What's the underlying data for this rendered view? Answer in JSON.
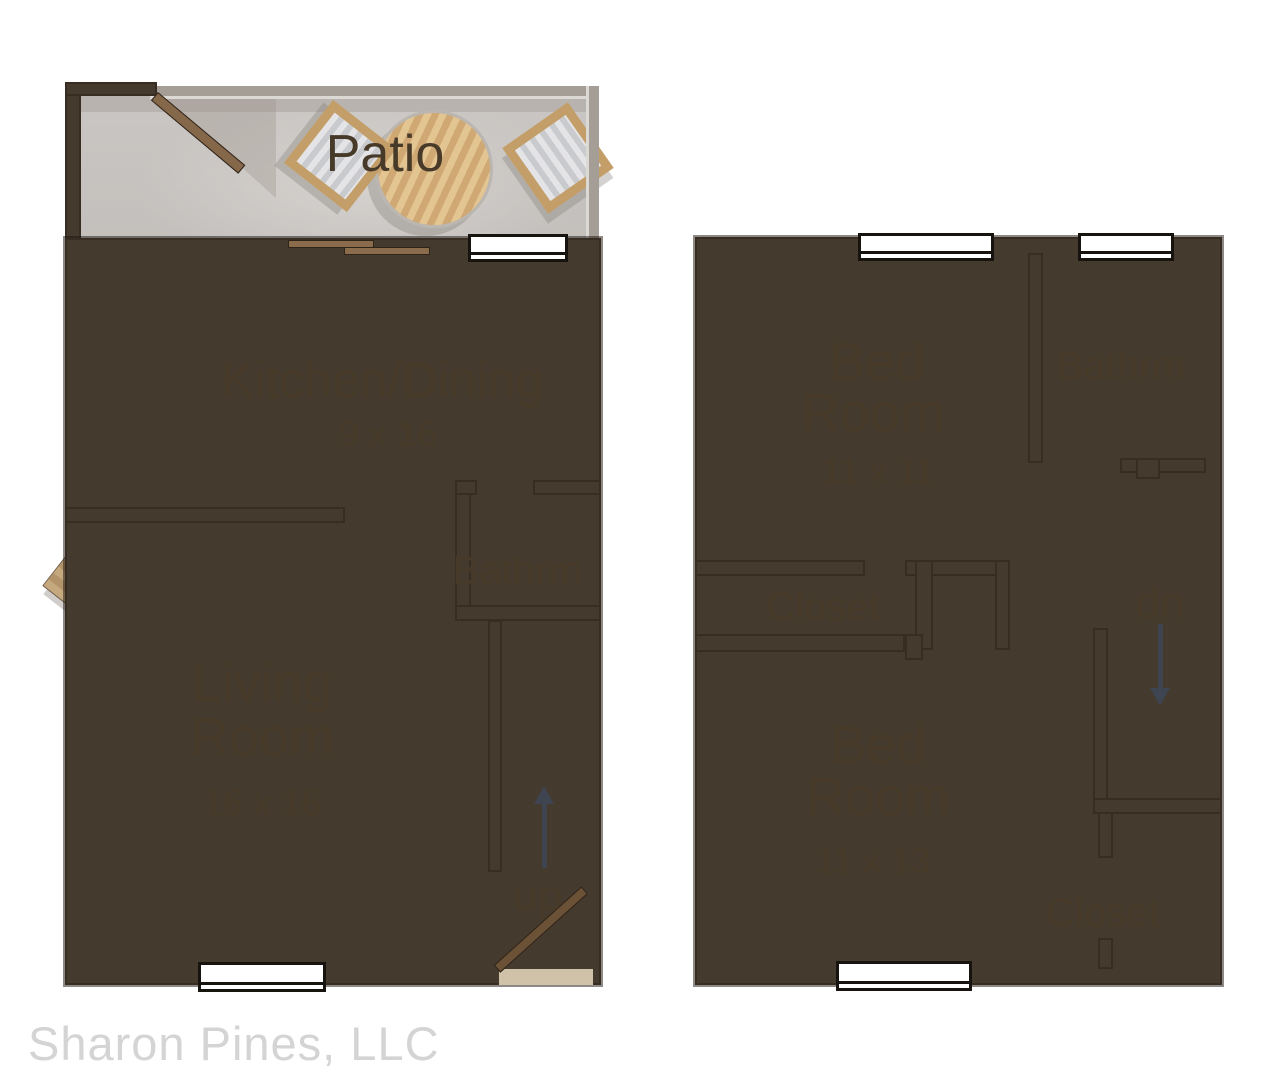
{
  "meta": {
    "watermark": "Sharon Pines, LLC"
  },
  "colors": {
    "wall": "#453a2e",
    "floor_base": "#d7c9ac",
    "floor_highlight": "#f2e9d3",
    "patio_floor": "#cac6c3",
    "kitchen_floor": "#fbfbf9",
    "closet_interior": "#f8f5ec",
    "label_text": "#473a29",
    "stair_arrow": "#3e4450",
    "wood": "#d2b283",
    "fixture_white": "#fdfdfb",
    "watermark_text": "#d4d4d4"
  },
  "first_floor": {
    "patio": {
      "label": "Patio"
    },
    "kitchen_dining": {
      "label": "Kitchen/Dining",
      "dimensions": "9 x 16"
    },
    "bathroom": {
      "label": "Bathrm"
    },
    "living_room": {
      "label_line1": "Living",
      "label_line2": "Room",
      "dimensions": "16 x 16"
    },
    "stairs": {
      "label": "up"
    }
  },
  "second_floor": {
    "bedroom1": {
      "label_line1": "Bed",
      "label_line2": "Room",
      "dimensions": "11 x 11"
    },
    "bathroom": {
      "label": "Bathrm"
    },
    "hall_closet": {
      "label": "Closet"
    },
    "stairs": {
      "label": "dn"
    },
    "bedroom2": {
      "label_line1": "Bed",
      "label_line2": "Room",
      "dimensions": "11 x 13"
    },
    "bedroom_closet": {
      "label": "Closet"
    }
  }
}
